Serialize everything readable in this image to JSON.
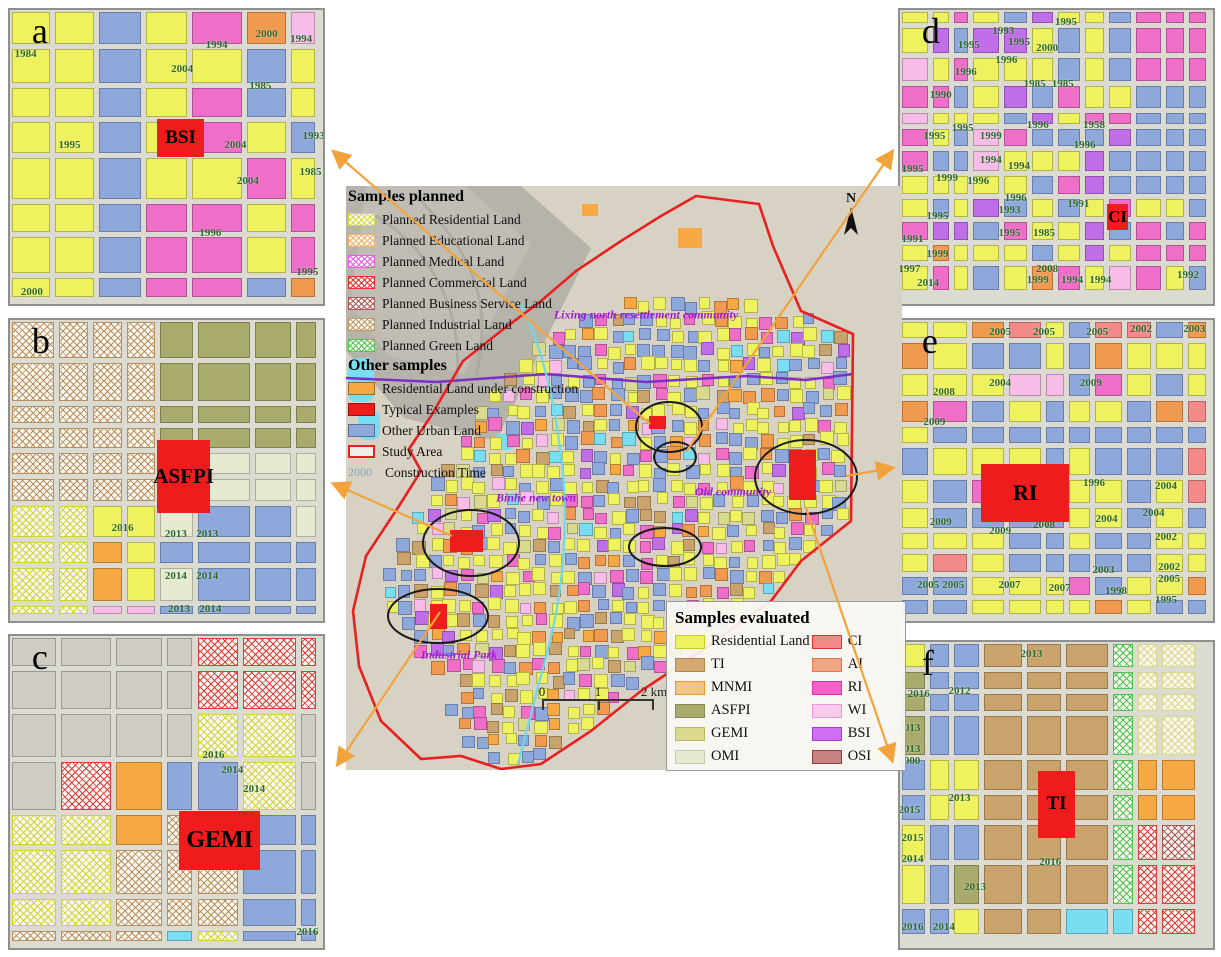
{
  "figure": {
    "type": "land-use-map-figure"
  },
  "colors": {
    "study_area": "#e82020",
    "arrow": "#f2a33c",
    "ellipse": "#1a1a1a",
    "typical_example": "#ee1c1c",
    "purple_line": "#7b2fc4",
    "cyan_line": "#6fd9ea",
    "terrain_base": "#d8d2c4",
    "river_valley": "#b6b3ab",
    "region_label": "#a21ad6",
    "year_label": "#2e6b2e"
  },
  "land_colors": {
    "yellow": {
      "color": "#eef25e",
      "pattern": "solid"
    },
    "blue": {
      "color": "#8fa8dc",
      "pattern": "solid"
    },
    "magenta": {
      "color": "#ee6ec8",
      "pattern": "solid"
    },
    "purple": {
      "color": "#c06ee8",
      "pattern": "solid"
    },
    "orange": {
      "color": "#f09a50",
      "pattern": "solid"
    },
    "under": {
      "color": "#f5a843",
      "pattern": "solid"
    },
    "tan": {
      "color": "#c9a36b",
      "pattern": "solid"
    },
    "olive": {
      "color": "#a9ab6d",
      "pattern": "solid"
    },
    "pale": {
      "color": "#e6ead0",
      "pattern": "solid"
    },
    "gemi": {
      "color": "#d9da8e",
      "pattern": "solid"
    },
    "pink": {
      "color": "#f8bce8",
      "pattern": "solid"
    },
    "ci": {
      "color": "#f28a8a",
      "pattern": "solid"
    },
    "terrain": {
      "color": "#cfccc3",
      "pattern": "solid"
    },
    "water": {
      "color": "#7adef2",
      "pattern": "solid"
    },
    "yellow_hatch": {
      "color": "#cfd23a",
      "pattern": "crosshatch"
    },
    "tan_hatch": {
      "color": "#b89060",
      "pattern": "crosshatch"
    },
    "red_hatch": {
      "color": "#e23b3b",
      "pattern": "crosshatch"
    },
    "green_hatch": {
      "color": "#4ec24e",
      "pattern": "crosshatch"
    },
    "maroon_hatch": {
      "color": "#a85555",
      "pattern": "crosshatch"
    },
    "paleyellow_hatch": {
      "color": "#d8d88a",
      "pattern": "crosshatch"
    }
  },
  "legend_planned": {
    "title": "Samples planned",
    "items": [
      {
        "label": "Planned Residential Land",
        "color": "#d6da3c"
      },
      {
        "label": "Planned Educational Land",
        "color": "#f4b06a"
      },
      {
        "label": "Planned  Medical Land",
        "color": "#ee58ee"
      },
      {
        "label": "Planned Commercial Land",
        "color": "#e83030"
      },
      {
        "label": "Planned Business Service Land",
        "color": "#b05858"
      },
      {
        "label": "Planned Industrial Land",
        "color": "#bf9a68"
      },
      {
        "label": "Planned Green Land",
        "color": "#52c852"
      }
    ]
  },
  "legend_other": {
    "title": "Other samples",
    "items": [
      {
        "label": "Residential Land under construction",
        "color": "#f5a843",
        "style": "solid"
      },
      {
        "label": "Typical Examples",
        "color": "#ee1c1c",
        "style": "solid"
      },
      {
        "label": "Other Urban Land",
        "color": "#8fa8dc",
        "style": "solid"
      },
      {
        "label": "Study Area",
        "color": "#e82020",
        "style": "outline"
      },
      {
        "label": "Construction Time",
        "color": "#8aa0b8",
        "style": "text",
        "text": "2000"
      }
    ]
  },
  "legend_evaluated": {
    "title": "Samples evaluated",
    "left": [
      {
        "label": "Residential Land",
        "color": "#eef25e",
        "border": "#c8c830"
      },
      {
        "label": "TI",
        "color": "#d3ab72",
        "border": "#b08850"
      },
      {
        "label": "MNMI",
        "color": "#f3c488",
        "border": "#e8952a"
      },
      {
        "label": "ASFPI",
        "color": "#a9ab6d",
        "border": "#888a50"
      },
      {
        "label": "GEMI",
        "color": "#d9da8e",
        "border": "#b8b86a"
      },
      {
        "label": "OMI",
        "color": "#e6ead0",
        "border": "#c6cab0"
      }
    ],
    "right": [
      {
        "label": "CI",
        "color": "#f28a8a",
        "border": "#e03030"
      },
      {
        "label": "AI",
        "color": "#efa483",
        "border": "#d87b50"
      },
      {
        "label": "RI",
        "color": "#f561c9",
        "border": "#e030a8"
      },
      {
        "label": "WI",
        "color": "#f9c9ee",
        "border": "#e898d8"
      },
      {
        "label": "BSI",
        "color": "#d06ef3",
        "border": "#a83ad8"
      },
      {
        "label": "OSI",
        "color": "#c98080",
        "border": "#8a4040"
      }
    ]
  },
  "map": {
    "north_label": "N",
    "scale_ticks": [
      "0",
      "1",
      "2 km"
    ],
    "labels": [
      {
        "text": "Lixing north resettlement community",
        "x": 300,
        "y": 129
      },
      {
        "text": "Binhe new town",
        "x": 190,
        "y": 312
      },
      {
        "text": "Old community",
        "x": 387,
        "y": 306
      },
      {
        "text": "Industrial Park",
        "x": 113,
        "y": 469
      }
    ]
  },
  "panels": [
    {
      "id": "a",
      "letter": "a",
      "example": {
        "label": "BSI",
        "x": 47,
        "y": 37,
        "w": 15,
        "h": 13,
        "fs": 19
      },
      "years": [
        [
          "1984",
          5,
          15
        ],
        [
          "2000",
          82,
          8
        ],
        [
          "1994",
          66,
          12
        ],
        [
          "1994",
          93,
          10
        ],
        [
          "2004",
          55,
          20
        ],
        [
          "1985",
          80,
          26
        ],
        [
          "1995",
          19,
          46
        ],
        [
          "2004",
          72,
          46
        ],
        [
          "1993",
          97,
          43
        ],
        [
          "1985",
          96,
          55
        ],
        [
          "2004",
          76,
          58
        ],
        [
          "1996",
          64,
          76
        ],
        [
          "1995",
          95,
          89
        ],
        [
          "2000",
          7,
          96
        ]
      ]
    },
    {
      "id": "b",
      "letter": "b",
      "example": {
        "label": "ASFPI",
        "x": 47,
        "y": 40,
        "w": 17,
        "h": 24,
        "fs": 21
      },
      "years": [
        [
          "2016",
          36,
          69
        ],
        [
          "2013",
          53,
          71
        ],
        [
          "2013",
          63,
          71
        ],
        [
          "2014",
          53,
          85
        ],
        [
          "2014",
          63,
          85
        ],
        [
          "2013",
          54,
          96
        ],
        [
          "2014",
          64,
          96
        ]
      ]
    },
    {
      "id": "c",
      "letter": "c",
      "example": {
        "label": "GEMI",
        "x": 54,
        "y": 56,
        "w": 26,
        "h": 19,
        "fs": 24
      },
      "years": [
        [
          "2016",
          65,
          38
        ],
        [
          "2014",
          71,
          43
        ],
        [
          "2014",
          78,
          49
        ],
        [
          "2016",
          95,
          95
        ]
      ]
    },
    {
      "id": "d",
      "letter": "d",
      "example": {
        "label": "CI",
        "x": 66,
        "y": 66,
        "w": 7,
        "h": 9,
        "fs": 17
      },
      "years": [
        [
          "1995",
          53,
          4
        ],
        [
          "1993",
          33,
          7
        ],
        [
          "1995",
          22,
          12
        ],
        [
          "1995",
          38,
          11
        ],
        [
          "2000",
          47,
          13
        ],
        [
          "1996",
          34,
          17
        ],
        [
          "1996",
          21,
          21
        ],
        [
          "1985",
          43,
          25
        ],
        [
          "1985",
          52,
          25
        ],
        [
          "1990",
          13,
          29
        ],
        [
          "1995",
          20,
          40
        ],
        [
          "1995",
          11,
          43
        ],
        [
          "1999",
          29,
          43
        ],
        [
          "1996",
          44,
          39
        ],
        [
          "1958",
          62,
          39
        ],
        [
          "1996",
          59,
          46
        ],
        [
          "1994",
          29,
          51
        ],
        [
          "1994",
          38,
          53
        ],
        [
          "1995",
          4,
          54
        ],
        [
          "1999",
          15,
          57
        ],
        [
          "1996",
          25,
          58
        ],
        [
          "1996",
          37,
          64
        ],
        [
          "1993",
          35,
          68
        ],
        [
          "1991",
          57,
          66
        ],
        [
          "1995",
          12,
          70
        ],
        [
          "1995",
          35,
          76
        ],
        [
          "1985",
          46,
          76
        ],
        [
          "1991",
          4,
          78
        ],
        [
          "1999",
          12,
          83
        ],
        [
          "1997",
          3,
          88
        ],
        [
          "2014",
          9,
          93
        ],
        [
          "2008",
          47,
          88
        ],
        [
          "1999",
          44,
          92
        ],
        [
          "1994",
          55,
          92
        ],
        [
          "1994",
          64,
          92
        ],
        [
          "1992",
          92,
          90
        ]
      ]
    },
    {
      "id": "e",
      "letter": "e",
      "example": {
        "label": "RI",
        "x": 26,
        "y": 48,
        "w": 28,
        "h": 19,
        "fs": 22
      },
      "years": [
        [
          "2005",
          32,
          4
        ],
        [
          "2005",
          46,
          4
        ],
        [
          "2005",
          63,
          4
        ],
        [
          "2002",
          77,
          3
        ],
        [
          "2003",
          94,
          3
        ],
        [
          "2008",
          14,
          24
        ],
        [
          "2004",
          32,
          21
        ],
        [
          "2009",
          61,
          21
        ],
        [
          "2009",
          11,
          34
        ],
        [
          "1996",
          62,
          54
        ],
        [
          "2004",
          85,
          55
        ],
        [
          "2009",
          13,
          67
        ],
        [
          "2009",
          32,
          70
        ],
        [
          "2008",
          46,
          68
        ],
        [
          "2004",
          66,
          66
        ],
        [
          "2004",
          81,
          64
        ],
        [
          "2002",
          85,
          72
        ],
        [
          "2005",
          9,
          88
        ],
        [
          "2005",
          17,
          88
        ],
        [
          "2007",
          35,
          88
        ],
        [
          "2007",
          51,
          89
        ],
        [
          "2003",
          65,
          83
        ],
        [
          "1998",
          69,
          90
        ],
        [
          "2002",
          86,
          82
        ],
        [
          "2005",
          86,
          86
        ],
        [
          "1995",
          85,
          93
        ]
      ]
    },
    {
      "id": "f",
      "letter": "f",
      "example": {
        "label": "TI",
        "x": 44,
        "y": 42,
        "w": 12,
        "h": 22,
        "fs": 19
      },
      "years": [
        [
          "2013",
          42,
          4
        ],
        [
          "2016",
          6,
          17
        ],
        [
          "2012",
          19,
          16
        ],
        [
          "2013",
          3,
          28
        ],
        [
          "2013",
          3,
          35
        ],
        [
          "2000",
          3,
          39
        ],
        [
          "2013",
          19,
          51
        ],
        [
          "2015",
          3,
          55
        ],
        [
          "2015",
          4,
          64
        ],
        [
          "2014",
          4,
          71
        ],
        [
          "2016",
          48,
          72
        ],
        [
          "2013",
          24,
          80
        ],
        [
          "2016",
          4,
          93
        ],
        [
          "2014",
          14,
          93
        ]
      ]
    }
  ]
}
